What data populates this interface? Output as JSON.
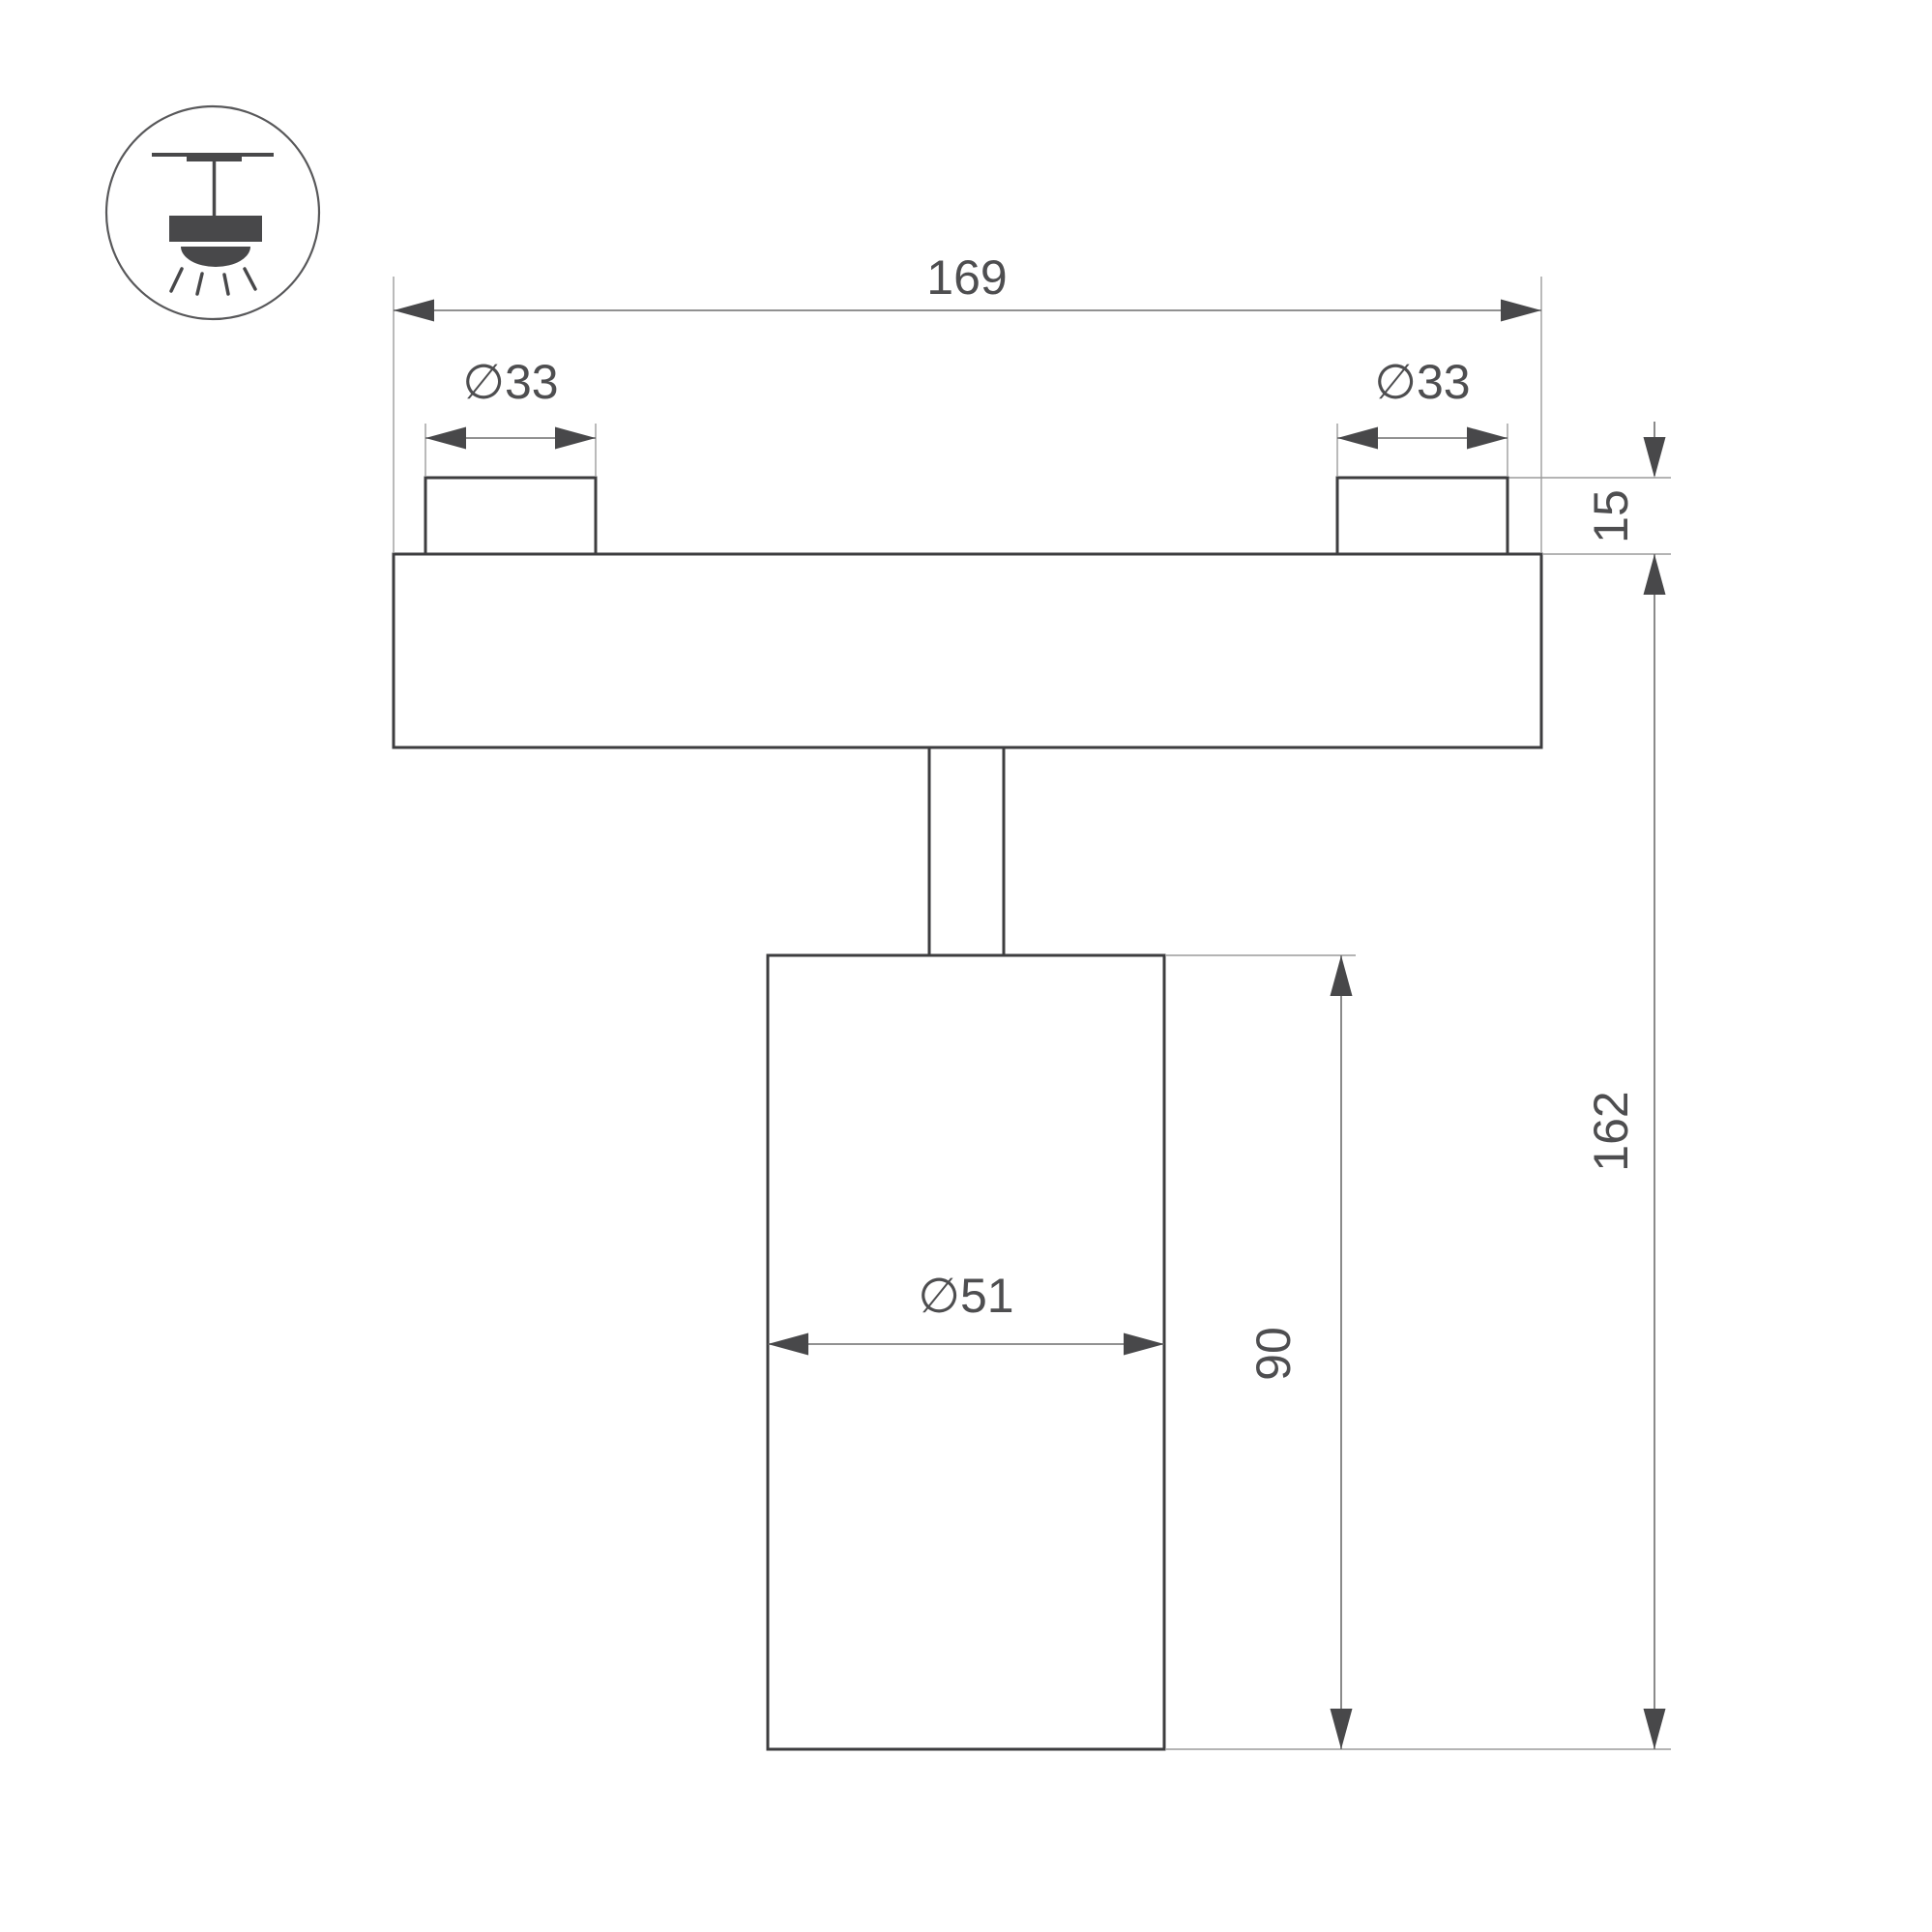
{
  "drawing": {
    "icon": {
      "name": "ceiling-track-pendant-light"
    },
    "dimensions": {
      "overall_width": "169",
      "left_boss_diameter": "∅33",
      "right_boss_diameter": "∅33",
      "boss_height": "15",
      "overall_height": "162",
      "body_height": "90",
      "body_diameter": "∅51"
    },
    "colors": {
      "outline": "#3d3d3f",
      "dimension_line": "#6d6d6d",
      "extension_line": "#9c9c9c",
      "arrow": "#48484a",
      "label_text": "#4e4e50",
      "icon": "#48484a",
      "icon_circle": "#58585a",
      "background": "#ffffff"
    }
  }
}
